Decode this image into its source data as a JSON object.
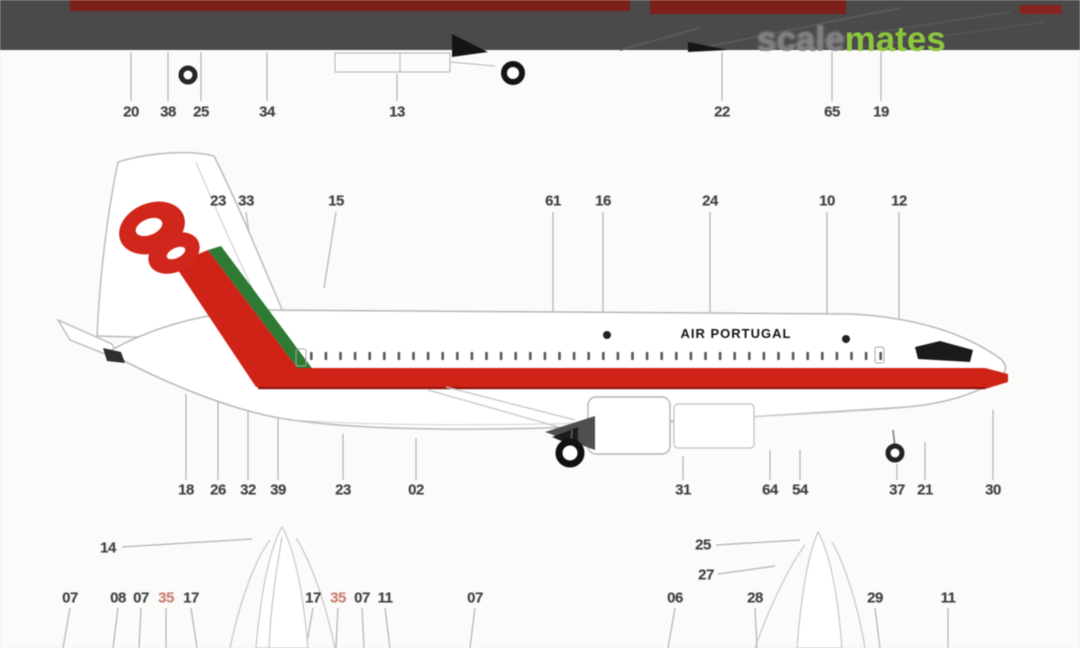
{
  "page": {
    "background": "#fbfbfa"
  },
  "top_bar": {
    "bar_color": "#4b4949",
    "dark_red_color": "#7c201a"
  },
  "watermark": {
    "scale": "scale",
    "mates": "mates",
    "scale_color": "#7d7d7d",
    "mates_color": "#8cc63e"
  },
  "aircraft": {
    "title": "AIR PORTUGAL",
    "livery_red": "#cf2317",
    "livery_green": "#2c7a33",
    "cheatline_edge": "#8e120c"
  },
  "callouts": {
    "color": "#3f3f3f",
    "red_color": "#c97c72",
    "items": [
      {
        "label": "20",
        "x": 131,
        "y": 112
      },
      {
        "label": "38",
        "x": 168,
        "y": 112
      },
      {
        "label": "25",
        "x": 201,
        "y": 112
      },
      {
        "label": "34",
        "x": 267,
        "y": 112
      },
      {
        "label": "13",
        "x": 397,
        "y": 112
      },
      {
        "label": "22",
        "x": 722,
        "y": 112
      },
      {
        "label": "65",
        "x": 832,
        "y": 112
      },
      {
        "label": "19",
        "x": 881,
        "y": 112
      },
      {
        "label": "23",
        "x": 218,
        "y": 201
      },
      {
        "label": "33",
        "x": 246,
        "y": 201
      },
      {
        "label": "15",
        "x": 336,
        "y": 201
      },
      {
        "label": "61",
        "x": 553,
        "y": 201
      },
      {
        "label": "16",
        "x": 603,
        "y": 201
      },
      {
        "label": "24",
        "x": 710,
        "y": 201
      },
      {
        "label": "10",
        "x": 827,
        "y": 201
      },
      {
        "label": "12",
        "x": 899,
        "y": 201
      },
      {
        "label": "18",
        "x": 186,
        "y": 490
      },
      {
        "label": "26",
        "x": 218,
        "y": 490
      },
      {
        "label": "32",
        "x": 248,
        "y": 490
      },
      {
        "label": "39",
        "x": 278,
        "y": 490
      },
      {
        "label": "23",
        "x": 343,
        "y": 490
      },
      {
        "label": "02",
        "x": 416,
        "y": 490
      },
      {
        "label": "31",
        "x": 683,
        "y": 490
      },
      {
        "label": "64",
        "x": 770,
        "y": 490
      },
      {
        "label": "54",
        "x": 800,
        "y": 490
      },
      {
        "label": "37",
        "x": 897,
        "y": 490
      },
      {
        "label": "21",
        "x": 925,
        "y": 490
      },
      {
        "label": "30",
        "x": 993,
        "y": 490
      },
      {
        "label": "14",
        "x": 108,
        "y": 548
      },
      {
        "label": "25",
        "x": 703,
        "y": 545
      },
      {
        "label": "27",
        "x": 706,
        "y": 575
      },
      {
        "label": "07",
        "x": 70,
        "y": 598
      },
      {
        "label": "08",
        "x": 118,
        "y": 598
      },
      {
        "label": "07",
        "x": 141,
        "y": 598
      },
      {
        "label": "35",
        "x": 166,
        "y": 598,
        "red": true
      },
      {
        "label": "17",
        "x": 191,
        "y": 598
      },
      {
        "label": "17",
        "x": 313,
        "y": 598
      },
      {
        "label": "35",
        "x": 338,
        "y": 598,
        "red": true
      },
      {
        "label": "07",
        "x": 362,
        "y": 598
      },
      {
        "label": "11",
        "x": 385,
        "y": 598
      },
      {
        "label": "07",
        "x": 475,
        "y": 598
      },
      {
        "label": "06",
        "x": 675,
        "y": 598
      },
      {
        "label": "28",
        "x": 755,
        "y": 598
      },
      {
        "label": "29",
        "x": 875,
        "y": 598
      },
      {
        "label": "11",
        "x": 948,
        "y": 598
      }
    ]
  }
}
